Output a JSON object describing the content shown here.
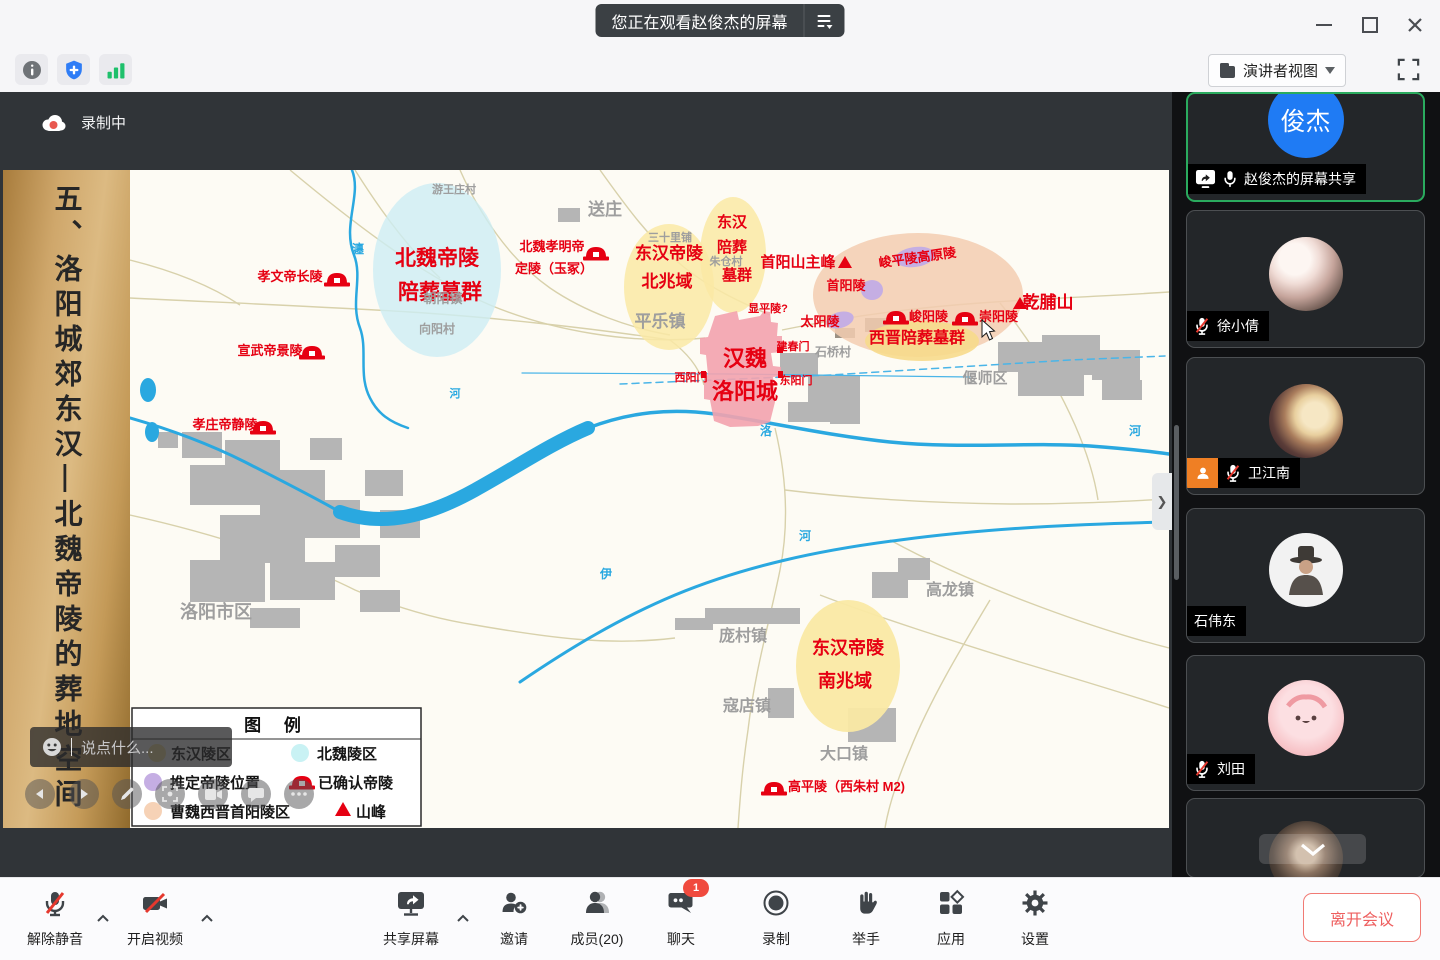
{
  "win": {
    "title": "您正在观看赵俊杰的屏幕"
  },
  "header": {
    "view_mode": "演讲者视图"
  },
  "recording": {
    "label": "录制中"
  },
  "slide": {
    "vertical_title": "五、洛阳城郊东汉—北魏帝陵的葬地空间"
  },
  "chat_overlay": {
    "placeholder": "说点什么..."
  },
  "map": {
    "colors": {
      "accent_red": "#e60012",
      "region_yellow": "#fae9a4",
      "region_cyan": "#cdeef4",
      "region_orange": "#f3cdb0",
      "region_purple": "#c5aee3",
      "city_pink": "#f3a2ae",
      "river_blue": "#2aa8e0"
    },
    "legend": {
      "title": "图 例",
      "donghan": "东汉陵区",
      "beiwei": "北魏陵区",
      "tuiding": "推定帝陵位置",
      "queren": "已确认帝陵",
      "caowei": "曹魏西晋首阳陵区",
      "shanfeng": "山峰"
    },
    "labels": [
      {
        "id": "beiwei-diling",
        "t": "北魏帝陵",
        "x": 307,
        "y": 95,
        "s": 21,
        "c": "red"
      },
      {
        "id": "beiwei-peizang",
        "t": "陪葬墓群",
        "x": 310,
        "y": 129,
        "s": 21,
        "c": "red"
      },
      {
        "id": "xiaowendi-changling",
        "t": "孝文帝长陵",
        "x": 160,
        "y": 111,
        "s": 13,
        "c": "red"
      },
      {
        "id": "xuanwudi-jingling",
        "t": "宣武帝景陵",
        "x": 140,
        "y": 185,
        "s": 13,
        "c": "red"
      },
      {
        "id": "xiaozhuangdi-jingling",
        "t": "孝庄帝静陵",
        "x": 95,
        "y": 259,
        "s": 13,
        "c": "red"
      },
      {
        "id": "xiaomingdi-1",
        "t": "北魏孝明帝",
        "x": 422,
        "y": 81,
        "s": 13,
        "c": "red"
      },
      {
        "id": "xiaomingdi-2",
        "t": "定陵（玉冢）",
        "x": 424,
        "y": 103,
        "s": 13,
        "c": "red"
      },
      {
        "id": "donghan-north-1",
        "t": "东汉帝陵",
        "x": 539,
        "y": 89,
        "s": 17,
        "c": "red"
      },
      {
        "id": "donghan-north-2",
        "t": "北兆域",
        "x": 537,
        "y": 117,
        "s": 17,
        "c": "red"
      },
      {
        "id": "donghan-pei-1",
        "t": "东汉",
        "x": 602,
        "y": 57,
        "s": 15,
        "c": "red"
      },
      {
        "id": "donghan-pei-2",
        "t": "陪葬",
        "x": 602,
        "y": 82,
        "s": 15,
        "c": "red"
      },
      {
        "id": "donghan-pei-3",
        "t": "墓群",
        "x": 607,
        "y": 110,
        "s": 15,
        "c": "red"
      },
      {
        "id": "shouyangshan-peak",
        "t": "首阳山主峰",
        "x": 668,
        "y": 97,
        "s": 15,
        "c": "red"
      },
      {
        "id": "shouyangling",
        "t": "首阳陵",
        "x": 716,
        "y": 120,
        "s": 13,
        "c": "red"
      },
      {
        "id": "junpingling-gaoyuanling",
        "t": "峻平陵高原陵",
        "x": 788,
        "y": 92,
        "s": 13,
        "c": "red",
        "r": -8
      },
      {
        "id": "taiyangling",
        "t": "太阳陵",
        "x": 690,
        "y": 156,
        "s": 13,
        "c": "red"
      },
      {
        "id": "junyangling",
        "t": "峻阳陵",
        "x": 779,
        "y": 151,
        "s": 13,
        "c": "red",
        "a": "start"
      },
      {
        "id": "chongyangling",
        "t": "崇阳陵",
        "x": 849,
        "y": 151,
        "s": 13,
        "c": "red",
        "a": "start"
      },
      {
        "id": "qianfushan",
        "t": "乾脯山",
        "x": 918,
        "y": 138,
        "s": 17,
        "c": "red"
      },
      {
        "id": "xijin-peizang",
        "t": "西晋陪葬墓群",
        "x": 787,
        "y": 173,
        "s": 16,
        "c": "red"
      },
      {
        "id": "hanwei",
        "t": "汉魏",
        "x": 615,
        "y": 196,
        "s": 22,
        "c": "red"
      },
      {
        "id": "luoyangcheng",
        "t": "洛阳城",
        "x": 615,
        "y": 229,
        "s": 22,
        "c": "red"
      },
      {
        "id": "xianpingling",
        "t": "显平陵?",
        "x": 638,
        "y": 142,
        "s": 11,
        "c": "red"
      },
      {
        "id": "jianchunmen",
        "t": "建春门",
        "x": 663,
        "y": 180,
        "s": 11,
        "c": "red"
      },
      {
        "id": "xiyangmen",
        "t": "西阳门",
        "x": 561,
        "y": 211,
        "s": 11,
        "c": "red"
      },
      {
        "id": "dongyangmen",
        "t": "东阳门",
        "x": 666,
        "y": 214,
        "s": 11,
        "c": "red"
      },
      {
        "id": "gaopingling",
        "t": "高平陵（西朱村 M2)",
        "x": 658,
        "y": 621,
        "s": 13,
        "c": "red",
        "a": "start"
      },
      {
        "id": "donghan-south-1",
        "t": "东汉帝陵",
        "x": 718,
        "y": 484,
        "s": 18,
        "c": "red"
      },
      {
        "id": "donghan-south-2",
        "t": "南兆域",
        "x": 715,
        "y": 517,
        "s": 18,
        "c": "red"
      },
      {
        "id": "youwangzhuangcun",
        "t": "游王庄村",
        "x": 324,
        "y": 23,
        "s": 11,
        "c": "gray"
      },
      {
        "id": "songzhuang",
        "t": "送庄",
        "x": 475,
        "y": 45,
        "s": 17,
        "c": "gray"
      },
      {
        "id": "sanshilipu",
        "t": "三十里铺",
        "x": 540,
        "y": 71,
        "s": 11,
        "c": "gray"
      },
      {
        "id": "zhucangcun",
        "t": "朱仓村",
        "x": 596,
        "y": 95,
        "s": 11,
        "c": "gray"
      },
      {
        "id": "pinglezhen",
        "t": "平乐镇",
        "x": 530,
        "y": 157,
        "s": 17,
        "c": "gray"
      },
      {
        "id": "chaoyangzhen",
        "t": "朝阳镇",
        "x": 313,
        "y": 133,
        "s": 13,
        "c": "gray"
      },
      {
        "id": "xiangyangcun",
        "t": "向阳村",
        "x": 307,
        "y": 163,
        "s": 12,
        "c": "gray"
      },
      {
        "id": "shiqiaocun",
        "t": "石桥村",
        "x": 703,
        "y": 186,
        "s": 12,
        "c": "gray"
      },
      {
        "id": "yanshiqu",
        "t": "偃师区",
        "x": 855,
        "y": 213,
        "s": 15,
        "c": "gray"
      },
      {
        "id": "luoyang-city",
        "t": "洛阳市区",
        "x": 86,
        "y": 448,
        "s": 18,
        "c": "gray"
      },
      {
        "id": "gaolongzhen",
        "t": "高龙镇",
        "x": 820,
        "y": 425,
        "s": 16,
        "c": "gray"
      },
      {
        "id": "pangcunzhen",
        "t": "庞村镇",
        "x": 613,
        "y": 471,
        "s": 16,
        "c": "gray"
      },
      {
        "id": "koudianzhen",
        "t": "寇店镇",
        "x": 617,
        "y": 541,
        "s": 16,
        "c": "gray"
      },
      {
        "id": "dakouzhen",
        "t": "大口镇",
        "x": 714,
        "y": 589,
        "s": 16,
        "c": "gray"
      },
      {
        "id": "river-chan",
        "t": "瀍",
        "x": 228,
        "y": 83,
        "s": 12,
        "c": "blue"
      },
      {
        "id": "river-he-w",
        "t": "河",
        "x": 325,
        "y": 227,
        "s": 11,
        "c": "blue"
      },
      {
        "id": "river-luo",
        "t": "洛",
        "x": 636,
        "y": 265,
        "s": 12,
        "c": "blue"
      },
      {
        "id": "river-he-s",
        "t": "河",
        "x": 675,
        "y": 370,
        "s": 12,
        "c": "blue"
      },
      {
        "id": "river-yi",
        "t": "伊",
        "x": 476,
        "y": 408,
        "s": 12,
        "c": "blue"
      },
      {
        "id": "river-he-e",
        "t": "河",
        "x": 1005,
        "y": 265,
        "s": 12,
        "c": "blue"
      }
    ],
    "tombs": [
      {
        "x": 194,
        "y": 100
      },
      {
        "x": 453,
        "y": 74
      },
      {
        "x": 169,
        "y": 173
      },
      {
        "x": 120,
        "y": 248
      },
      {
        "x": 753,
        "y": 138
      },
      {
        "x": 822,
        "y": 139
      },
      {
        "x": 631,
        "y": 609
      }
    ],
    "mountains": [
      {
        "x": 708,
        "y": 86
      },
      {
        "x": 883,
        "y": 127
      }
    ]
  },
  "sidebar": {
    "participants": [
      {
        "avatar_text": "俊杰",
        "tag": "赵俊杰的屏幕共享"
      },
      {
        "tag": "徐小倩"
      },
      {
        "tag": "卫江南"
      },
      {
        "tag": "石伟东"
      },
      {
        "tag": "刘田"
      },
      {
        "tag": ""
      }
    ]
  },
  "dock": {
    "mute": "解除静音",
    "video": "开启视频",
    "share": "共享屏幕",
    "invite": "邀请",
    "members": "成员(20)",
    "chat": "聊天",
    "chat_badge": "1",
    "record": "录制",
    "raise_hand": "举手",
    "apps": "应用",
    "settings": "设置",
    "leave": "离开会议"
  }
}
